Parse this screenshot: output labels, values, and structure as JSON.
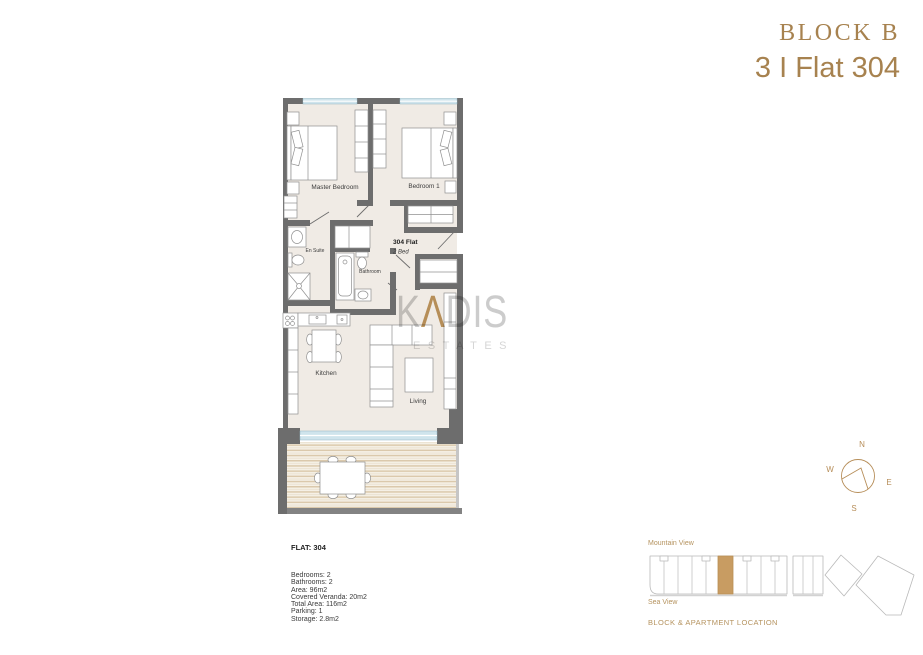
{
  "header": {
    "block_title": "BLOCK B",
    "flat_title": "3 I Flat 304"
  },
  "floorplan": {
    "unit_label": "304 Flat",
    "unit_type": "2 Bed",
    "rooms": {
      "master_bedroom": "Master Bedroom",
      "bedroom1": "Bedroom 1",
      "en_suite": "En Suite",
      "bathroom": "Bathroom",
      "kitchen": "Kitchen",
      "living": "Living"
    }
  },
  "watermark": {
    "part1": "K",
    "accent": "Λ",
    "part2": "DIS",
    "subtitle": "ESTATES"
  },
  "compass": {
    "north": "N",
    "south": "S",
    "east": "E",
    "west": "W"
  },
  "details": {
    "title": "FLAT: 304",
    "lines": [
      "Bedrooms: 2",
      "Bathrooms: 2",
      "Area: 96m2",
      "Covered Veranda: 20m2",
      "Total Area: 116m2",
      "Parking: 1",
      "Storage: 2.8m2"
    ]
  },
  "locator": {
    "mountain_view": "Mountain View",
    "sea_view": "Sea View",
    "caption": "BLOCK & APARTMENT LOCATION"
  },
  "colors": {
    "accent_gold": "#a7824f",
    "locator_gold": "#b5935f",
    "unit_highlight": "#c89c62",
    "wall": "#6d6d6d",
    "floor": "#f0ebe5",
    "window": "#cfe4ec"
  }
}
